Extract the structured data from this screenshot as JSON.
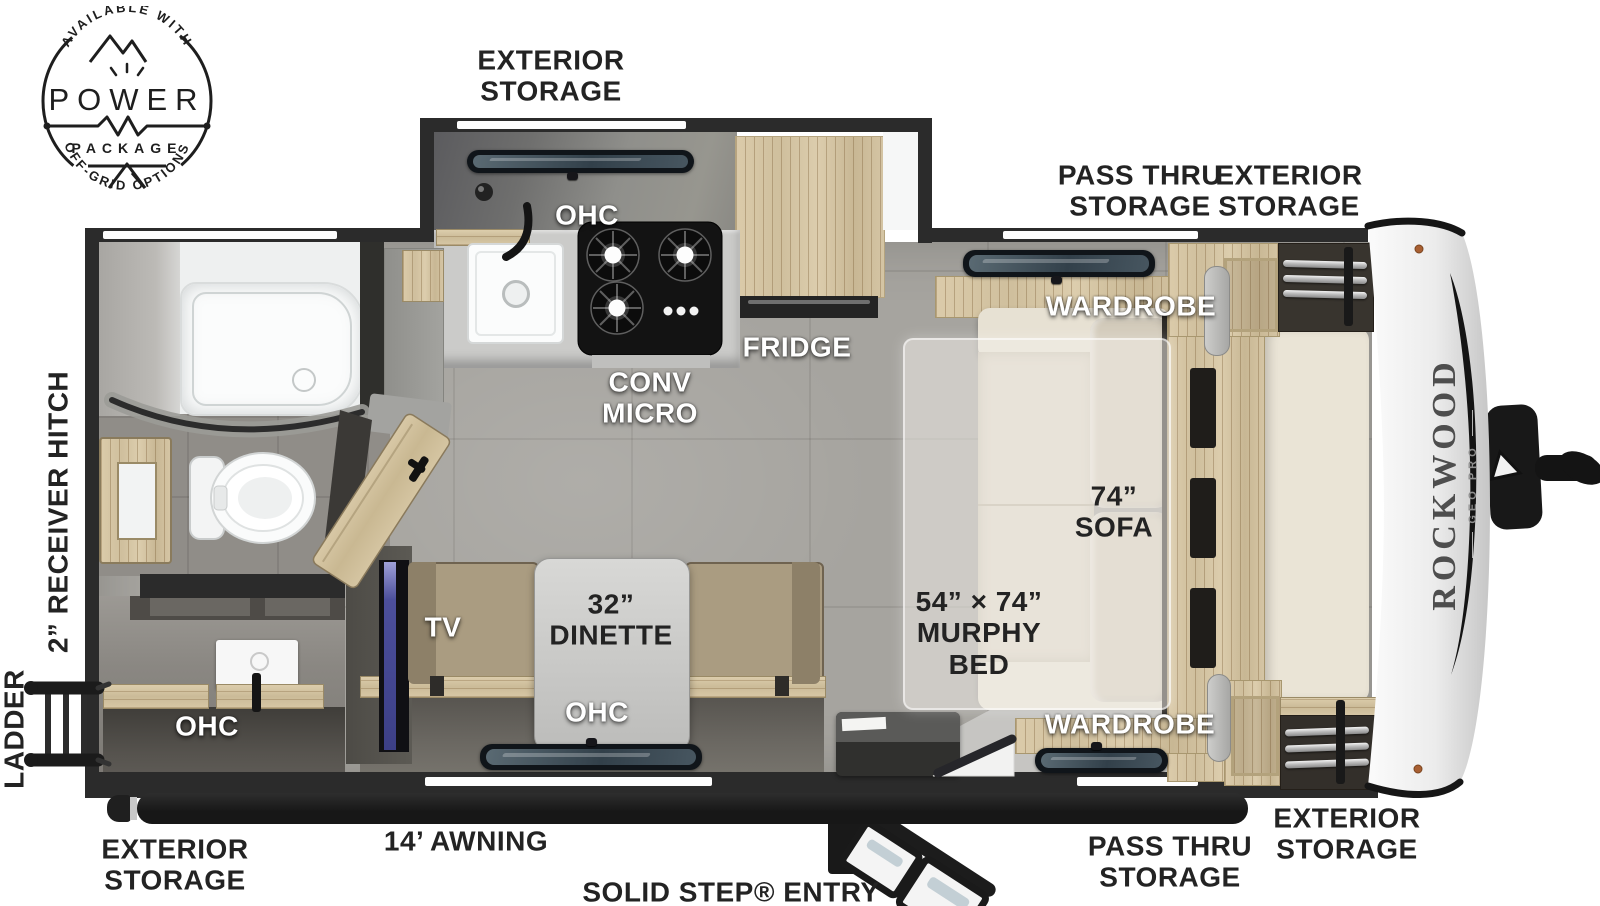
{
  "badge": {
    "arc_top": "AVAILABLE WITH",
    "word": "POWER",
    "word2": "PACKAGE",
    "arc_bottom": "OFF-GRID OPTIONS"
  },
  "front_cap": {
    "brand": "ROCKWOOD",
    "model": "GEO PRO"
  },
  "exterior_labels": {
    "storage_top_left": "EXTERIOR\nSTORAGE",
    "pass_thru_top": "PASS THRU\nSTORAGE",
    "storage_top_right": "EXTERIOR\nSTORAGE",
    "receiver_hitch": "2” RECEIVER HITCH",
    "ladder": "LADDER",
    "storage_bottom_left": "EXTERIOR\nSTORAGE",
    "awning": "14’ AWNING",
    "solid_step": "SOLID STEP® ENTRY",
    "pass_thru_bottom": "PASS THRU\nSTORAGE",
    "storage_bottom_right": "EXTERIOR\nSTORAGE"
  },
  "interior_labels": {
    "ohc_kitchen": "OHC",
    "conv_micro": "CONV\nMICRO",
    "fridge": "FRIDGE",
    "wardrobe_top": "WARDROBE",
    "sofa": "74”\nSOFA",
    "murphy_bed": "54” × 74”\nMURPHY\nBED",
    "wardrobe_bottom": "WARDROBE",
    "tv": "TV",
    "dinette": "32”\nDINETTE",
    "ohc_dinette": "OHC",
    "ohc_rear": "OHC"
  },
  "colors": {
    "wall": "#2b2b2b",
    "floor": "#a6a49f",
    "wood": "#d3c3a1",
    "sofa": "#dcd5c6",
    "counter": "#cbcbc9",
    "awning": "#1f1f1f",
    "front_cap": "#f0f0f0",
    "label_dark": "#232323",
    "label_light": "#ffffff"
  }
}
